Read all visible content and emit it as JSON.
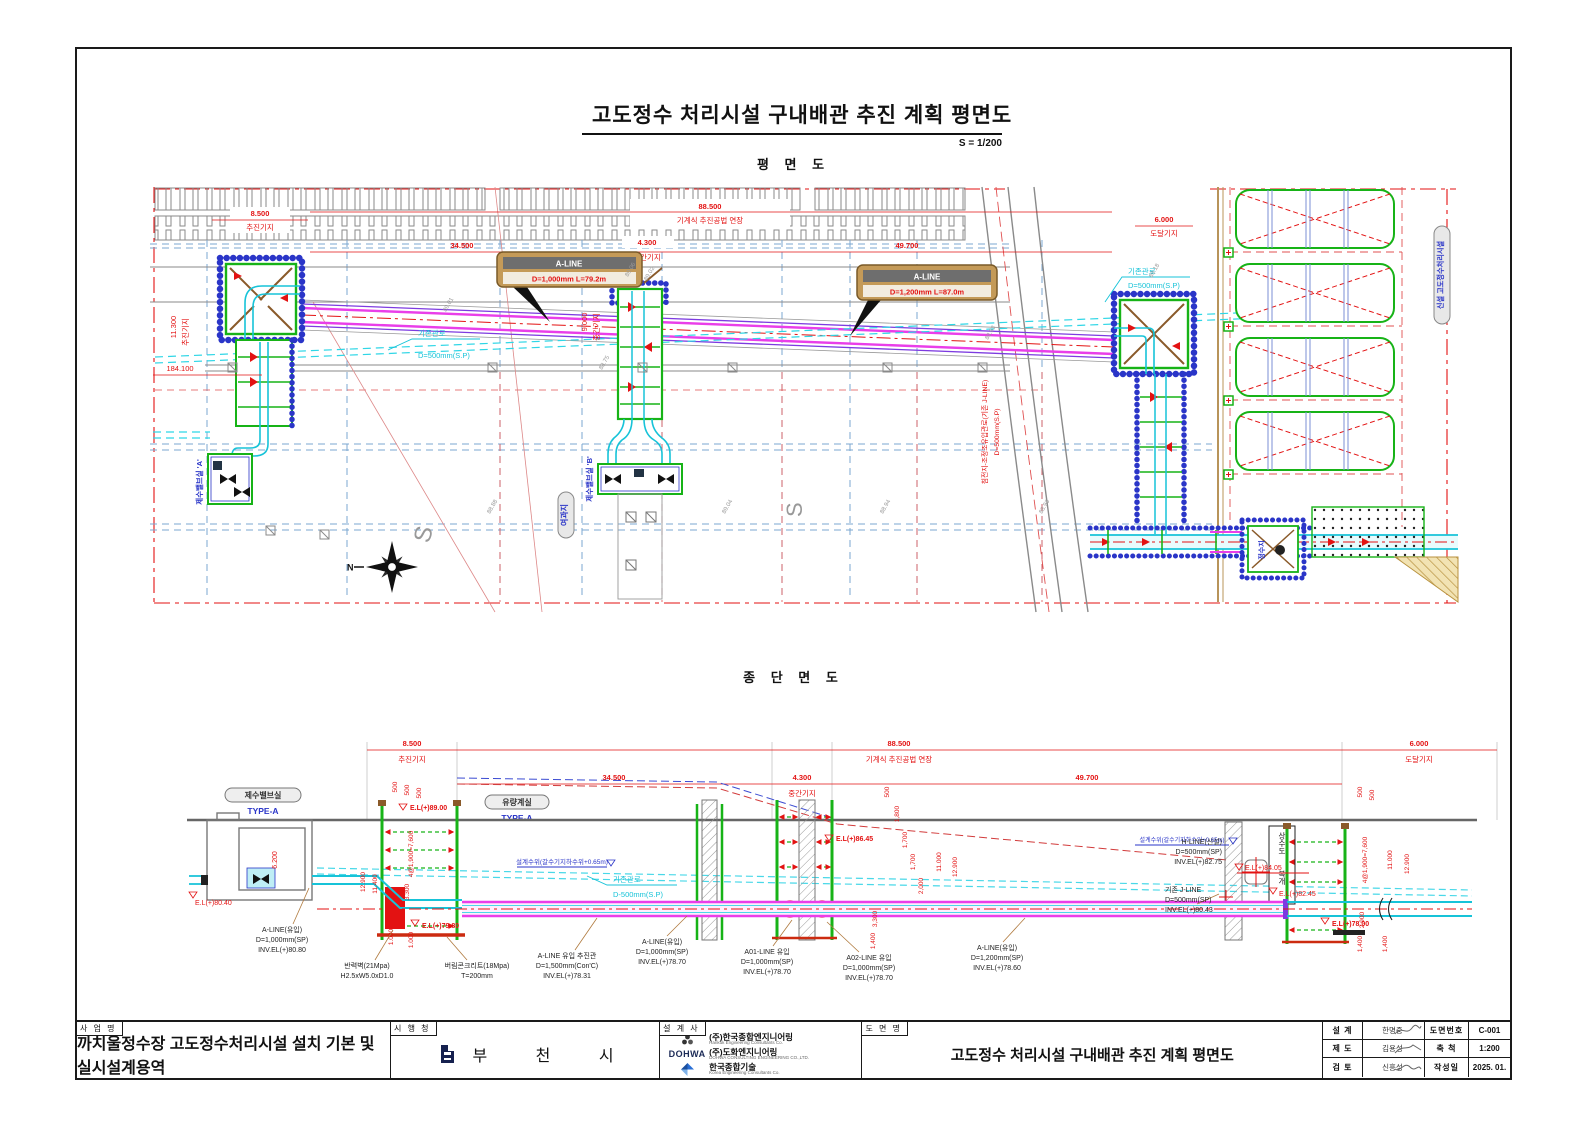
{
  "sheet": {
    "title": "고도정수 처리시설 구내배관 추진 계획 평면도",
    "scale": "S = 1/200",
    "plan_heading": "평 면 도",
    "section_heading": "종 단 면 도"
  },
  "plan": {
    "dims": {
      "d8500": "8.500",
      "jacking_base": "추진기지",
      "d88500": "88.500",
      "mech_ext": "기계식 추진공법 연장",
      "d6000": "6.000",
      "arrival_base": "도달기지",
      "d34500": "34.500",
      "d4300": "4.300",
      "mid_base": "중간기지",
      "d49700": "49.700",
      "d184100": "184.100",
      "d11300": "11.300",
      "d9000": "9.000"
    },
    "callouts": {
      "aline": "A-LINE",
      "aline1_spec": "D=1,000mm L=79.2m",
      "aline2_spec": "D=1,200mm L=87.0m",
      "existing1": "기존관로",
      "existing1_spec": "D=500mm(S.P)",
      "existing2": "기존관로",
      "existing2_spec": "D=500mm(S.P)",
      "jline": "침전지-조정조유입관로(기존 J-LINE)",
      "jline_spec": "D=500mm(S.P)"
    },
    "labels": {
      "valve_a": "제수밸브실 'A'",
      "valve_b": "제수밸브실 'B'",
      "filter": "여과지",
      "basin": "정수지",
      "facility": "신설 고도정수처리시설",
      "road_s": "S",
      "north": "N"
    },
    "spots": [
      "89.06",
      "89.02",
      "88.88",
      "89.04",
      "88.94",
      "89.18",
      "88.83",
      "88.75",
      "88.93",
      "89.01"
    ]
  },
  "section": {
    "labels": {
      "valve_room": "제수밸브실",
      "type_a": "TYPE-A",
      "flow_room": "유량계실",
      "waterworks_line1": "상수도",
      "waterworks_line2": "복개",
      "wl": "설계수위(갈수기지하수위+0.65m)",
      "existing1": "기존관로",
      "existing1_spec": "D-500mm(S.P)",
      "dim_6200": "6.200",
      "el_8900": "E.L(+)89.00",
      "el_8040": "E.L(+)80.40",
      "el_7980": "E.L(+)79.80",
      "el_8645": "E.L(+)86.45",
      "el_8405": "E.L(+)84.05",
      "el_8245": "E.L(+)82.45",
      "el_7800": "E.L(+)78.00"
    },
    "v_dims": {
      "left": [
        "500",
        "500",
        "500",
        "4@1,900=7,600",
        "12.900",
        "11.400",
        "3.300",
        "1.000",
        "1.000"
      ],
      "mid": [
        "500",
        "1,800",
        "1,700",
        "1,700",
        "2,000",
        "11.000",
        "12.900",
        "3,300",
        "1,400"
      ],
      "right": [
        "500",
        "500",
        "4@1,900=7,600",
        "11.000",
        "12.900",
        "2,900",
        "1,400",
        "1,400"
      ]
    },
    "callouts": [
      {
        "l1": "A-LINE(유입)",
        "l2": "D=1,000mm(SP)",
        "l3": "INV.EL(+)80.80"
      },
      {
        "l1": "반력벽(21Mpa)",
        "l2": "H2.5xW5.0xD1.0",
        "l3": ""
      },
      {
        "l1": "버림콘크리트(18Mpa)",
        "l2": "T=200mm",
        "l3": ""
      },
      {
        "l1": "A-LINE 유입 추진관",
        "l2": "D=1,500mm(Con'C)",
        "l3": "INV.EL(+)78.31"
      },
      {
        "l1": "A-LINE(유입)",
        "l2": "D=1,000mm(SP)",
        "l3": "INV.EL(+)78.70"
      },
      {
        "l1": "A01-LINE 유입",
        "l2": "D=1,000mm(SP)",
        "l3": "INV.EL(+)78.70"
      },
      {
        "l1": "A02-LINE 유입",
        "l2": "D=1,000mm(SP)",
        "l3": "INV.EL(+)78.70"
      },
      {
        "l1": "A-LINE(유입)",
        "l2": "D=1,200mm(SP)",
        "l3": "INV.EL(+)78.60"
      },
      {
        "l1": "기존 J-LINE",
        "l2": "D=500mm(SP)",
        "l3": "INV.EL(+)80.43"
      },
      {
        "l1": "H-LINE(신설)",
        "l2": "D=500mm(SP)",
        "l3": "INV.EL(+)82.75"
      }
    ]
  },
  "titleblock": {
    "project_label": "사 업 명",
    "project_name": "까치울정수장 고도정수처리시설 설치 기본 및 실시설계용역",
    "client_label": "시 행 청",
    "client_name": "부 천 시",
    "designer_label": "설 계 사",
    "companies": [
      {
        "name": "(주)한국종합엔지니어링",
        "sub": "Hankuk Engineering Consultants Co."
      },
      {
        "logo_text": "DOHWA",
        "name": "(주)도화엔지니어링",
        "sub": "DOHWA CONSULTING ENGINEERING CO.,LTD."
      },
      {
        "name": "한국종합기술",
        "sub": "Korea Engineering Consultants Co."
      }
    ],
    "drawing_label": "도 면 명",
    "drawing_name": "고도정수 처리시설 구내배관 추진 계획 평면도",
    "sign_rows": [
      {
        "role": "설  계",
        "name": "한명중"
      },
      {
        "role": "제  도",
        "name": "김용성"
      },
      {
        "role": "검  토",
        "name": "신흥성"
      }
    ],
    "meta_rows": [
      {
        "label": "도면번호",
        "value": "C-001"
      },
      {
        "label": "축  척",
        "value": "1:200"
      },
      {
        "label": "작성일",
        "value": "2025. 01."
      }
    ]
  }
}
